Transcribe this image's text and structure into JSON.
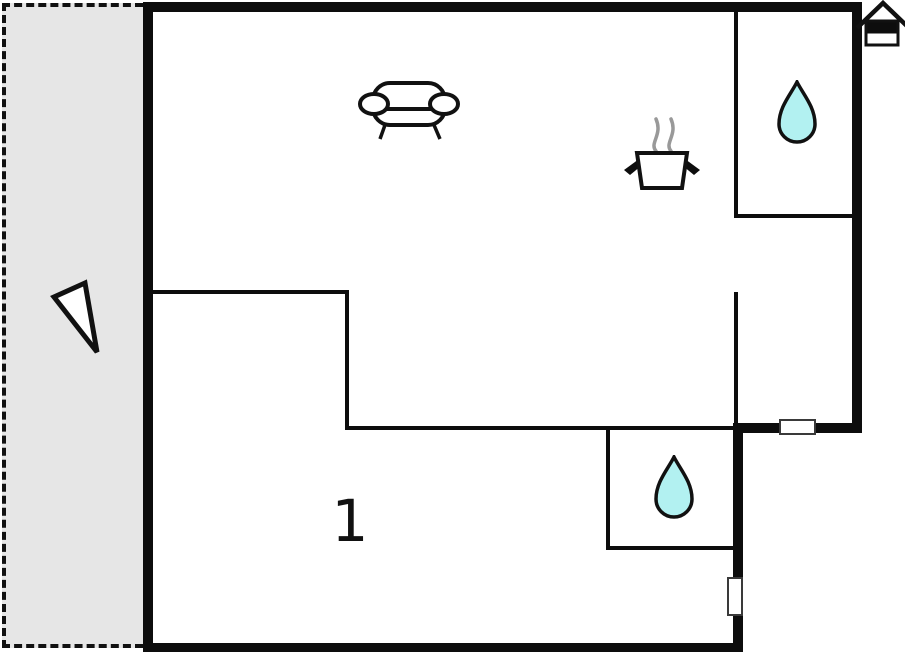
{
  "floor_plan": {
    "room_label": "1",
    "colors": {
      "background": "#ffffff",
      "wall": "#0d0d0d",
      "outline": "#111111",
      "terrace_fill": "#e6e6e6",
      "terrace_border": "#111111",
      "drop_fill": "#b2f1f1",
      "steam": "#999999",
      "window_fill": "#ffffff",
      "window_border": "#3a3a3a"
    },
    "icons": [
      {
        "name": "north-arrow-icon",
        "meaning": "direction triangle on terrace"
      },
      {
        "name": "sofa-icon",
        "meaning": "living room seating"
      },
      {
        "name": "cooking-pot-icon",
        "meaning": "kitchen"
      },
      {
        "name": "steam-icon",
        "meaning": "steam above pot"
      },
      {
        "name": "water-drop-icon",
        "meaning": "bathroom top right"
      },
      {
        "name": "water-drop-icon",
        "meaning": "bathroom bottom middle"
      },
      {
        "name": "house-icon",
        "meaning": "entrance marker top right"
      },
      {
        "name": "window-marker",
        "meaning": "window in right step wall"
      },
      {
        "name": "window-marker",
        "meaning": "window in lower right wall"
      }
    ]
  }
}
